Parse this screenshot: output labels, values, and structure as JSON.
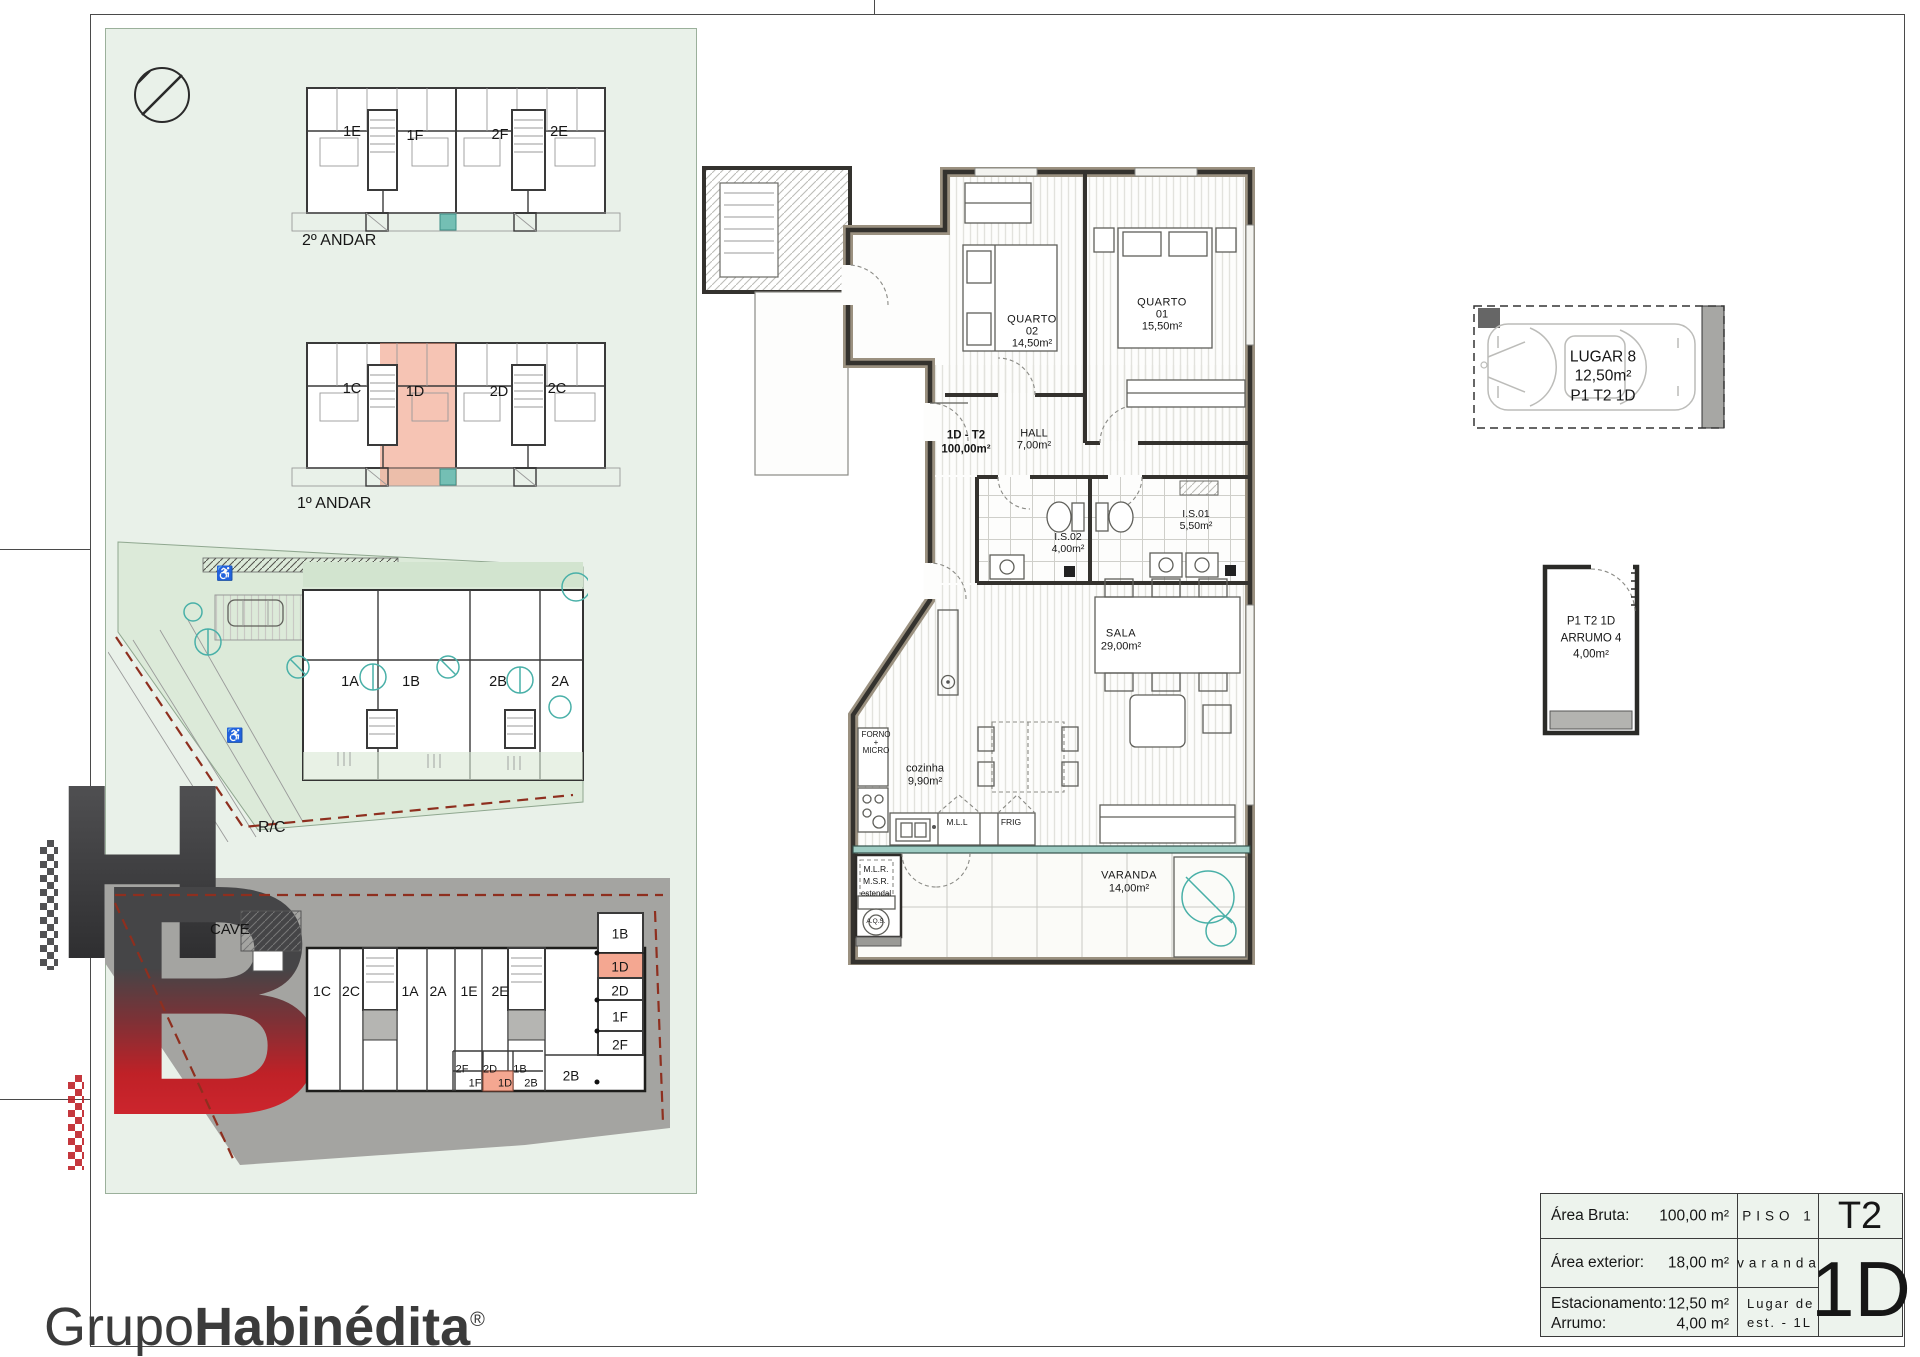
{
  "panel": {
    "floors": {
      "second": {
        "label": "2º ANDAR",
        "units": [
          "1E",
          "1F",
          "2F",
          "2E"
        ]
      },
      "first": {
        "label": "1º ANDAR",
        "units": [
          "1C",
          "1D",
          "2D",
          "2C"
        ],
        "highlighted": "1D"
      },
      "ground": {
        "label": "R/C",
        "units": [
          "1A",
          "1B",
          "2B",
          "2A"
        ]
      },
      "cave": {
        "label": "CAVE",
        "storage_row": [
          "1C",
          "2C",
          "1A",
          "2A",
          "1E",
          "2E"
        ],
        "cells_top": [
          "2F",
          "2D",
          "1B"
        ],
        "cells_bottom": [
          "1F",
          "1D",
          "2B"
        ],
        "legend": [
          "1B",
          "1D",
          "2D",
          "1F",
          "2F"
        ],
        "room_label": "2B",
        "highlighted": "1D"
      }
    }
  },
  "apartment": {
    "unit": {
      "name": "1D - T2",
      "area": "100,00m²"
    },
    "quarto02": {
      "l1": "QUARTO",
      "l2": "02",
      "l3": "14,50m²"
    },
    "quarto01": {
      "l1": "QUARTO",
      "l2": "01",
      "l3": "15,50m²"
    },
    "hall": {
      "l1": "HALL",
      "l2": "7,00m²"
    },
    "is02": {
      "l1": "I.S.02",
      "l2": "4,00m²"
    },
    "is01": {
      "l1": "I.S.01",
      "l2": "5,50m²"
    },
    "sala": {
      "l1": "SALA",
      "l2": "29,00m²"
    },
    "cozinha": {
      "l1": "cozinha",
      "l2": "9,90m²"
    },
    "varanda": {
      "l1": "VARANDA",
      "l2": "14,00m²"
    },
    "forno": {
      "l1": "FORNO",
      "l2": "+",
      "l3": "MICRO"
    },
    "mll": "M.L.L",
    "frig": "FRIG",
    "mlr": "M.L.R.",
    "msr": "M.S.R.",
    "estendal": "estendal",
    "aqs": "A.Q.S."
  },
  "parking": {
    "l1": "LUGAR 8",
    "l2": "12,50m²",
    "l3": "P1 T2 1D"
  },
  "storage": {
    "l1": "P1 T2 1D",
    "l2": "ARRUMO 4",
    "l3": "4,00m²"
  },
  "titleblock": {
    "area_bruta_label": "Área Bruta:",
    "area_bruta_value": "100,00 m²",
    "piso": "PISO 1",
    "type_code": "T2",
    "area_ext_label": "Área exterior:",
    "area_ext_value": "18,00 m²",
    "varanda": "varanda",
    "unit_code": "1D",
    "estac_label": "Estacionamento:",
    "estac_value": "12,50 m²",
    "arrumo_label": "Arrumo:",
    "arrumo_value": "4,00 m²",
    "lugar_l1": "Lugar de",
    "lugar_l2": "est. - 1L"
  },
  "logo": {
    "monogram_h": "H",
    "monogram_b": "B",
    "name_light": "Grupo",
    "name_bold": "Habinédita",
    "reg": "®"
  },
  "colors": {
    "highlight": "#f2a08a",
    "panel_green": "#e9f1e9",
    "cave_gray": "#a4a4a1",
    "teal": "#49b0a8",
    "red_boundary": "#8e2f1f",
    "logo_red": "#c22128"
  }
}
